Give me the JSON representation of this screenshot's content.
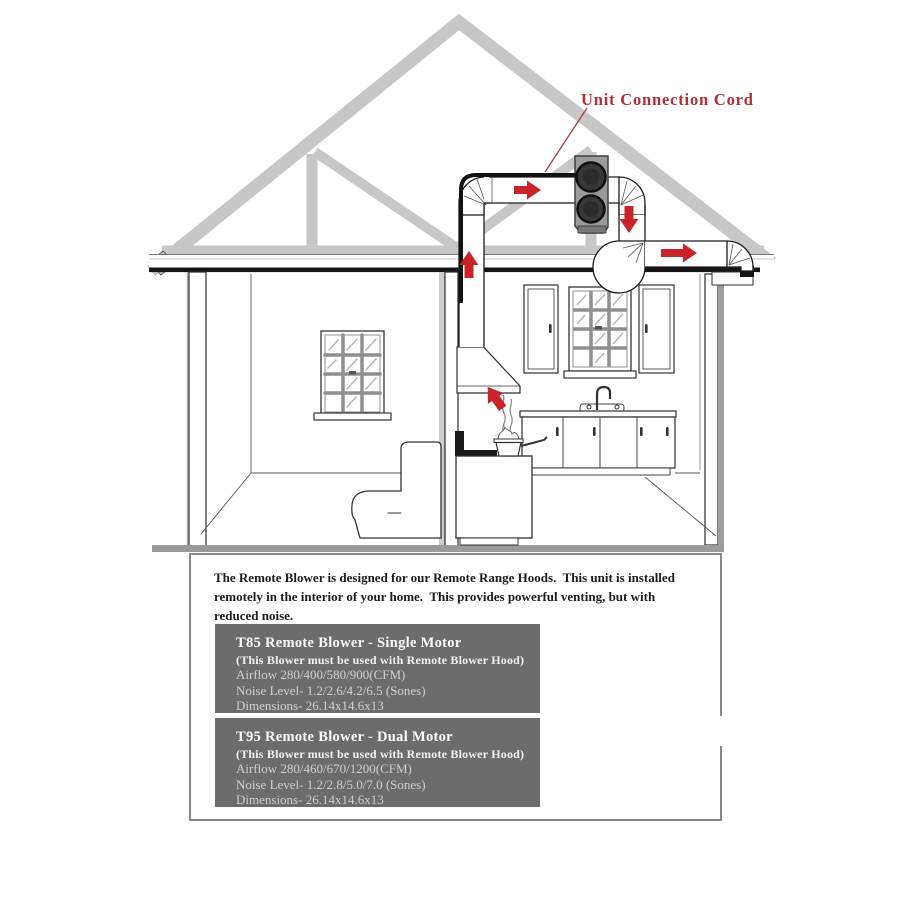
{
  "diagram": {
    "label_unit_connection_cord": "Unit Connection Cord"
  },
  "panel": {
    "paragraph_lines": [
      "The Remote Blower is designed for our Remote Range Hoods.  This unit is installed",
      "remotely in the interior of your home.  This provides powerful venting, but with",
      "reduced noise."
    ],
    "products": [
      {
        "title": "T85 Remote Blower - Single Motor",
        "note": "(This Blower must be used with Remote Blower Hood)",
        "airflow": "Airflow 280/400/580/900(CFM)",
        "noise": "Noise Level- 1.2/2.6/4.2/6.5 (Sones)",
        "dimensions": "Dimensions- 26.14x14.6x13"
      },
      {
        "title": "T95 Remote Blower - Dual Motor",
        "note": "(This Blower must be used with Remote Blower Hood)",
        "airflow": "Airflow 280/460/670/1200(CFM)",
        "noise": "Noise Level- 1.2/2.8/5.0/7.0 (Sones)",
        "dimensions": "Dimensions- 26.14x14.6x13"
      }
    ]
  },
  "colors": {
    "accent_red_text": "#b03035",
    "arrow_red": "#c8242a",
    "spec_box_gray": "#6c6c6c",
    "truss_gray": "#c7c7c7",
    "floor_gray": "#9a9a9a"
  }
}
